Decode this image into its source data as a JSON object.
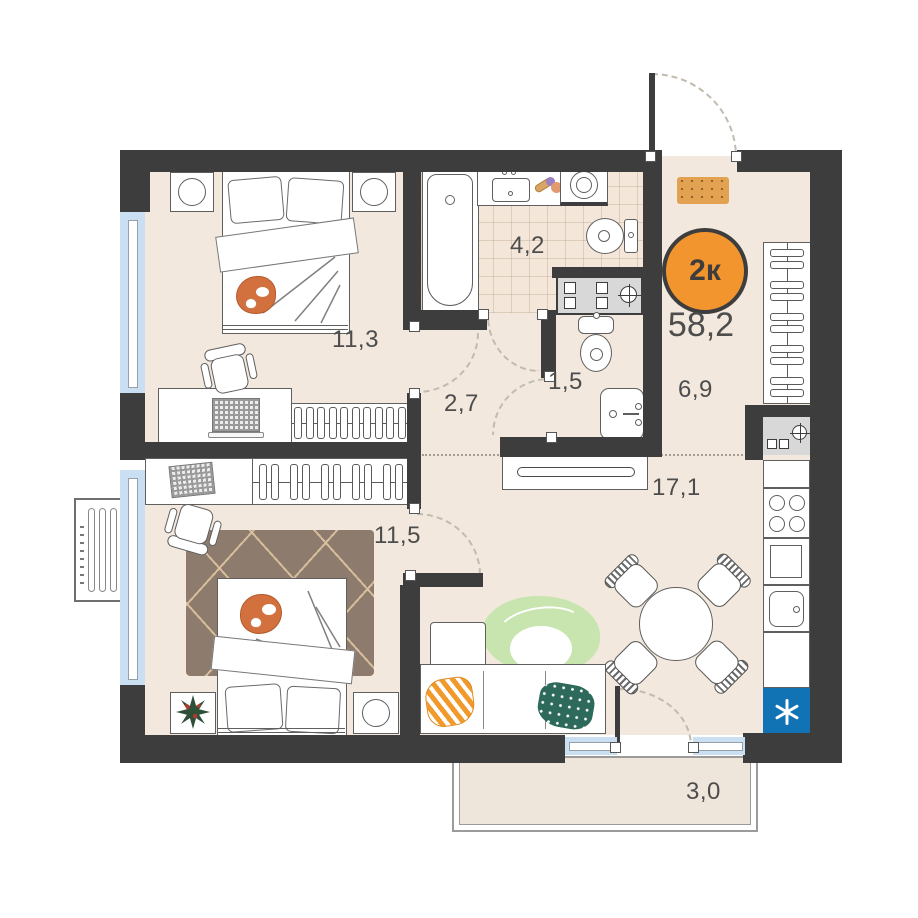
{
  "floorplan": {
    "badge": {
      "rooms_label": "2к",
      "total_area": "58,2"
    },
    "areas": {
      "bedroom_top": "11,3",
      "bathroom": "4,2",
      "wc": "1,5",
      "corridor": "2,7",
      "hallway": "6,9",
      "living_kitchen": "17,1",
      "bedroom_bottom": "11,5",
      "balcony": "3,0"
    },
    "colors": {
      "wall": "#3d3d3d",
      "floor": "#f2e8dd",
      "tile_floor": "#f4e7d9",
      "window": "#cadff2",
      "badge_orange": "#f2952e",
      "fridge_blue": "#1173b4",
      "doormat_orange": "#e3a251",
      "rug_brown": "#8d7c6d",
      "label_text": "#4d4d4d"
    }
  }
}
